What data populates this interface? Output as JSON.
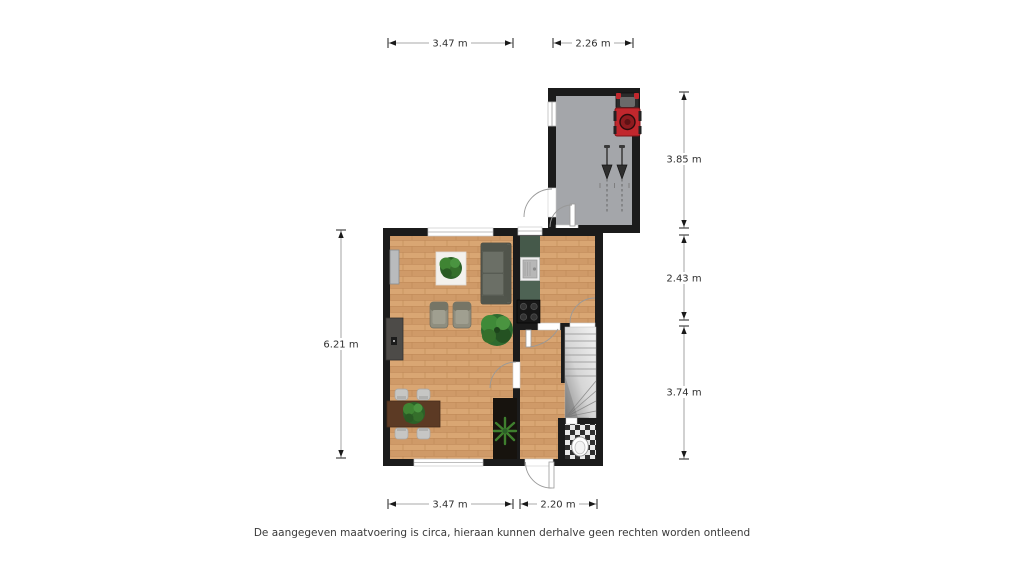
{
  "disclaimer": "De aangegeven maatvoering is circa, hieraan kunnen derhalve geen rechten worden ontleend",
  "dimensions": {
    "top_living": "3.47 m",
    "top_garage": "2.26 m",
    "right_garage": "3.85 m",
    "right_kitchen": "2.43 m",
    "right_hall": "3.74 m",
    "left_living": "6.21 m",
    "bottom_living": "3.47 m",
    "bottom_hall": "2.20 m"
  },
  "icons": {
    "lawnmower": "lawnmower-icon",
    "garden_tools": "garden-tools-icon",
    "sofa": "sofa-icon",
    "armchairs": "armchair-icon",
    "tv_panel": "tv-panel-icon",
    "sideboard": "sideboard-icon",
    "rug_plant": "rug-plant-icon",
    "monstera": "plant-icon",
    "palm": "palm-plant-icon",
    "dining_set": "dining-table-icon",
    "kitchen_counter": "kitchen-counter-icon",
    "sink": "sink-icon",
    "cooktop": "cooktop-icon",
    "stairs": "stairs-icon",
    "toilet": "toilet-icon",
    "door": "door-swing-icon",
    "window": "window-icon"
  },
  "colors": {
    "wall": "#1b1b1b",
    "wood_floor": "#d5a06f",
    "garage_floor": "#a4a6aa",
    "kitchen_counter": "#4e6354",
    "mower_red": "#c1272d",
    "plant_green": "#3c7a2e",
    "stair_gray": "#d9d9d9",
    "checker_dark": "#2f2f2f",
    "dimension_line": "#8c8c8c",
    "text": "#3b3b3b"
  }
}
